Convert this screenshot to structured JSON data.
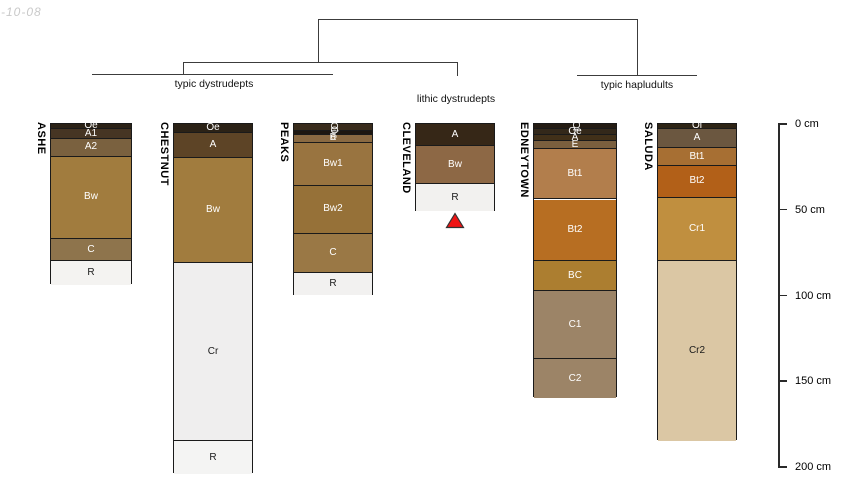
{
  "watermark": "-10-08",
  "chart_data": {
    "type": "bar",
    "subtype": "soil-profile-sketches-with-dendrogram",
    "title": "",
    "depth_axis": {
      "unit": "cm",
      "ticks": [
        {
          "cm": 0,
          "label": "0 cm"
        },
        {
          "cm": 50,
          "label": "50 cm"
        },
        {
          "cm": 100,
          "label": "100 cm"
        },
        {
          "cm": 150,
          "label": "150 cm"
        },
        {
          "cm": 200,
          "label": "200 cm"
        }
      ]
    },
    "groups": [
      {
        "label": "typic dystrudepts",
        "profiles": [
          "ASHE",
          "CHESTNUT",
          "PEAKS"
        ]
      },
      {
        "label": "lithic dystrudepts",
        "profiles": [
          "CLEVELAND"
        ]
      },
      {
        "label": "typic hapludults",
        "profiles": [
          "EDNEYTOWN",
          "SALUDA"
        ]
      }
    ],
    "profiles": [
      {
        "name": "ASHE",
        "group": "typic dystrudepts",
        "horizons": [
          {
            "name": "Oe",
            "top": 0,
            "bottom": 3,
            "color": "#2b2216",
            "text": "#ffffff",
            "rotated": false
          },
          {
            "name": "A1",
            "top": 3,
            "bottom": 9,
            "color": "#463523",
            "text": "#ffffff",
            "rotated": false
          },
          {
            "name": "A2",
            "top": 9,
            "bottom": 19,
            "color": "#7a613f",
            "text": "#ffffff",
            "rotated": false
          },
          {
            "name": "Bw",
            "top": 19,
            "bottom": 67,
            "color": "#a17c3e",
            "text": "#ffffff",
            "rotated": false
          },
          {
            "name": "C",
            "top": 67,
            "bottom": 80,
            "color": "#8e744c",
            "text": "#ffffff",
            "rotated": false
          },
          {
            "name": "R",
            "top": 80,
            "bottom": 94,
            "color": "#f4f3f1",
            "text": "#1a1a1a",
            "rotated": false
          }
        ]
      },
      {
        "name": "CHESTNUT",
        "group": "typic dystrudepts",
        "horizons": [
          {
            "name": "Oe",
            "top": 0,
            "bottom": 5,
            "color": "#2b2216",
            "text": "#ffffff",
            "rotated": false
          },
          {
            "name": "A",
            "top": 5,
            "bottom": 20,
            "color": "#5d4426",
            "text": "#ffffff",
            "rotated": false
          },
          {
            "name": "Bw",
            "top": 20,
            "bottom": 81,
            "color": "#a17c3e",
            "text": "#ffffff",
            "rotated": false
          },
          {
            "name": "Cr",
            "top": 81,
            "bottom": 185,
            "color": "#efeeee",
            "text": "#1a1a1a",
            "rotated": false
          },
          {
            "name": "R",
            "top": 185,
            "bottom": 204,
            "color": "#f4f4f3",
            "text": "#1a1a1a",
            "rotated": false
          }
        ]
      },
      {
        "name": "PEAKS",
        "group": "typic dystrudepts",
        "horizons": [
          {
            "name": "Oi",
            "top": 0,
            "bottom": 4,
            "color": "#392c1c",
            "text": "#ffffff",
            "rotated": true
          },
          {
            "name": "Oe",
            "top": 4,
            "bottom": 6.5,
            "color": "#1d1711",
            "text": "#ffffff",
            "rotated": true
          },
          {
            "name": "E",
            "top": 6.5,
            "bottom": 11,
            "color": "#8a6a42",
            "text": "#ffffff",
            "rotated": false
          },
          {
            "name": "Bw1",
            "top": 11,
            "bottom": 36,
            "color": "#997440",
            "text": "#ffffff",
            "rotated": false
          },
          {
            "name": "Bw2",
            "top": 36,
            "bottom": 64,
            "color": "#967138",
            "text": "#ffffff",
            "rotated": false
          },
          {
            "name": "C",
            "top": 64,
            "bottom": 87,
            "color": "#9a7845",
            "text": "#ffffff",
            "rotated": false
          },
          {
            "name": "R",
            "top": 87,
            "bottom": 100,
            "color": "#f2f1f0",
            "text": "#1a1a1a",
            "rotated": false
          }
        ]
      },
      {
        "name": "CLEVELAND",
        "group": "lithic dystrudepts",
        "marker": {
          "shape": "triangle-up",
          "fill": "#ee1414",
          "stroke": "#333333"
        },
        "horizons": [
          {
            "name": "A",
            "top": 0,
            "bottom": 13,
            "color": "#362717",
            "text": "#ffffff",
            "rotated": false
          },
          {
            "name": "Bw",
            "top": 13,
            "bottom": 35,
            "color": "#8d6845",
            "text": "#ffffff",
            "rotated": false
          },
          {
            "name": "R",
            "top": 35,
            "bottom": 51,
            "color": "#f2f1ef",
            "text": "#1a1a1a",
            "rotated": false
          }
        ]
      },
      {
        "name": "EDNEYTOWN",
        "group": "typic hapludults",
        "horizons": [
          {
            "name": "Oi",
            "top": 0,
            "bottom": 3,
            "color": "#241c13",
            "text": "#ffffff",
            "rotated": true
          },
          {
            "name": "Oe",
            "top": 3,
            "bottom": 6.5,
            "color": "#33281a",
            "text": "#ffffff",
            "rotated": false
          },
          {
            "name": "A",
            "top": 6.5,
            "bottom": 10,
            "color": "#413019",
            "text": "#ffffff",
            "rotated": false
          },
          {
            "name": "E",
            "top": 10,
            "bottom": 14.5,
            "color": "#7a5f3e",
            "text": "#ffffff",
            "rotated": false
          },
          {
            "name": "Bt1",
            "top": 14.5,
            "bottom": 44,
            "color": "#b27e4c",
            "text": "#ffffff",
            "rotated": false
          },
          {
            "name": "Bt2",
            "top": 44,
            "bottom": 80,
            "color": "#b76e22",
            "text": "#ffffff",
            "rotated": false
          },
          {
            "name": "BC",
            "top": 80,
            "bottom": 97.5,
            "color": "#ac7e30",
            "text": "#ffffff",
            "rotated": false
          },
          {
            "name": "C1",
            "top": 97.5,
            "bottom": 137,
            "color": "#9c8467",
            "text": "#ffffff",
            "rotated": false
          },
          {
            "name": "C2",
            "top": 137,
            "bottom": 160,
            "color": "#9c8467",
            "text": "#ffffff",
            "rotated": false
          }
        ]
      },
      {
        "name": "SALUDA",
        "group": "typic hapludults",
        "horizons": [
          {
            "name": "Oi",
            "top": 0,
            "bottom": 3,
            "color": "#2e2415",
            "text": "#ffffff",
            "rotated": false
          },
          {
            "name": "A",
            "top": 3,
            "bottom": 14,
            "color": "#6b5740",
            "text": "#ffffff",
            "rotated": false
          },
          {
            "name": "Bt1",
            "top": 14,
            "bottom": 24.5,
            "color": "#a76f33",
            "text": "#ffffff",
            "rotated": false
          },
          {
            "name": "Bt2",
            "top": 24.5,
            "bottom": 43,
            "color": "#b26018",
            "text": "#ffffff",
            "rotated": false
          },
          {
            "name": "Cr1",
            "top": 43,
            "bottom": 80,
            "color": "#c08f3f",
            "text": "#ffffff",
            "rotated": false
          },
          {
            "name": "Cr2",
            "top": 80,
            "bottom": 185,
            "color": "#dbc7a4",
            "text": "#1a1a1a",
            "rotated": false
          }
        ]
      }
    ]
  }
}
